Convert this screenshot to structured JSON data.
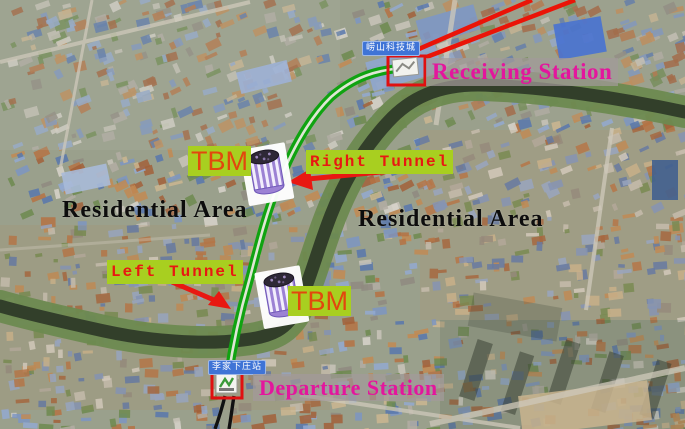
{
  "figure": {
    "type": "annotated-satellite-map",
    "description_visible_elements_only": true
  },
  "stations": {
    "receiving": {
      "label": "Receiving Station",
      "badge": "崂山科技城"
    },
    "departure": {
      "label": "Departure Station",
      "badge": "李家下庄站"
    }
  },
  "tunnels": {
    "right": "Right Tunnel",
    "left": "Left Tunnel"
  },
  "tbm": {
    "upper": "TBM",
    "lower": "TBM"
  },
  "areas": {
    "left": "Residential Area",
    "right": "Residential Area"
  },
  "colors": {
    "route_green": "#10a311",
    "route_gap": "#dfe6d5",
    "metro_line_red": "#ea1408",
    "arrow_red": "#e81812",
    "label_bg_yellow_green": "#a8cf20",
    "tbm_text_orange": "#e2470e",
    "tunnel_text_red": "#e81812",
    "station_text_magenta": "#e3169d",
    "station_label_bg": "rgba(162,154,154,0.72)",
    "area_text_black": "#0d0d0d",
    "badge_blue": "#3f74d6",
    "tbm_machine_purple": "#9c82d4",
    "river_water": "#323f2a",
    "river_banks_green": "#6d8a50",
    "rail_black": "#111111",
    "station_box_red": "#e01010"
  }
}
